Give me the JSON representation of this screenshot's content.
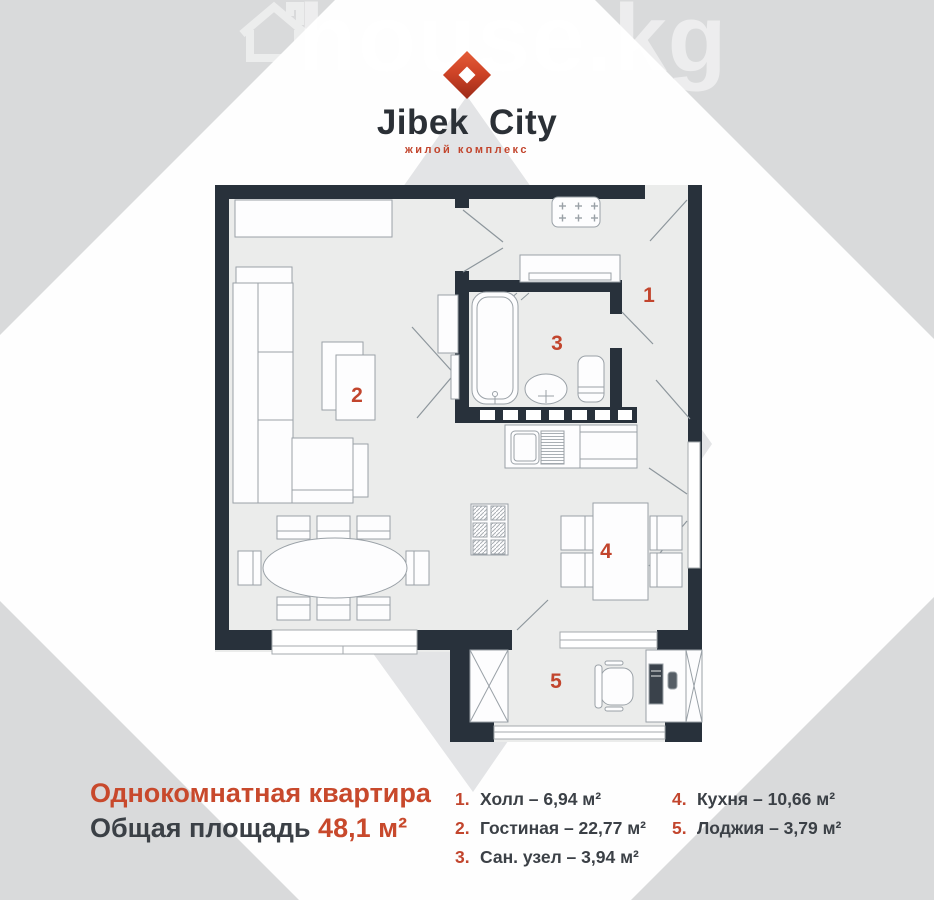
{
  "watermark": {
    "text": "house.kg"
  },
  "logo": {
    "brand": "Jibek City",
    "tagline": "жилой комплекс"
  },
  "plan": {
    "rooms": [
      {
        "number": "1"
      },
      {
        "number": "2"
      },
      {
        "number": "3"
      },
      {
        "number": "4"
      },
      {
        "number": "5"
      }
    ]
  },
  "title": {
    "line1": "Однокомнатная квартира",
    "area_label": "Общая площадь",
    "area_value": "48,1 м²"
  },
  "legend": {
    "items": [
      {
        "number": "1.",
        "text": "Холл – 6,94 м²"
      },
      {
        "number": "2.",
        "text": "Гостиная – 22,77 м²"
      },
      {
        "number": "3.",
        "text": "Сан. узел – 3,94 м²"
      },
      {
        "number": "4.",
        "text": "Кухня – 10,66 м²"
      },
      {
        "number": "5.",
        "text": "Лоджия – 3,79 м²"
      }
    ]
  },
  "colors": {
    "accent": "#c2452d",
    "wall": "#28313b",
    "floor": "#ebeceb",
    "background_gray": "#d9dadb",
    "text_dark": "#3b4046"
  }
}
